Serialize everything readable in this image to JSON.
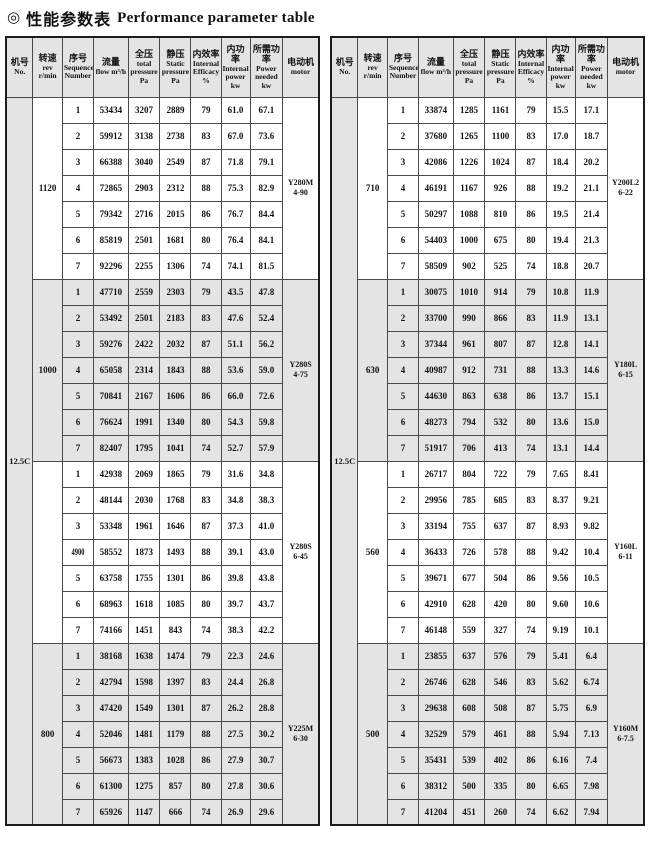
{
  "title": {
    "icon": "◎",
    "cn": "性能参数表",
    "en": "Performance parameter table"
  },
  "colors": {
    "shade": "#e4e4e4",
    "border": "#4a4a4a",
    "outer_border": "#1c1c1c",
    "text": "#111111"
  },
  "columns": [
    {
      "key": "no",
      "cn": "机号",
      "en": "No.",
      "w": "8.6%"
    },
    {
      "key": "rev",
      "cn": "转速",
      "en": "rev r/min",
      "w": "9.4%"
    },
    {
      "key": "seq",
      "cn": "序号",
      "en": "Sequence Number",
      "w": "10.0%"
    },
    {
      "key": "flow",
      "cn": "流量",
      "en": "flow m³/h",
      "w": "11.0%"
    },
    {
      "key": "total",
      "cn": "全压",
      "en": "total pressure Pa",
      "w": "10.2%"
    },
    {
      "key": "static",
      "cn": "静压",
      "en": "Static pressure Pa",
      "w": "9.9%"
    },
    {
      "key": "eff",
      "cn": "内效率",
      "en": "Internal Efficacy %",
      "w": "9.6%"
    },
    {
      "key": "ipow",
      "cn": "内功率",
      "en": "Internal power kw",
      "w": "9.3%"
    },
    {
      "key": "pneed",
      "cn": "所需功率",
      "en": "Power needed kw",
      "w": "10.4%"
    },
    {
      "key": "motor",
      "cn": "电动机",
      "en": "motor",
      "w": "11.6%"
    }
  ],
  "tables": [
    {
      "machine_no": "12.5C",
      "blocks": [
        {
          "rev": "1120",
          "motor": [
            "Y280M",
            "4-90"
          ],
          "shaded": false,
          "rows": [
            [
              "1",
              "53434",
              "3207",
              "2889",
              "79",
              "61.0",
              "67.1"
            ],
            [
              "2",
              "59912",
              "3138",
              "2738",
              "83",
              "67.0",
              "73.6"
            ],
            [
              "3",
              "66388",
              "3040",
              "2549",
              "87",
              "71.8",
              "79.1"
            ],
            [
              "4",
              "72865",
              "2903",
              "2312",
              "88",
              "75.3",
              "82.9"
            ],
            [
              "5",
              "79342",
              "2716",
              "2015",
              "86",
              "76.7",
              "84.4"
            ],
            [
              "6",
              "85819",
              "2501",
              "1681",
              "80",
              "76.4",
              "84.1"
            ],
            [
              "7",
              "92296",
              "2255",
              "1306",
              "74",
              "74.1",
              "81.5"
            ]
          ]
        },
        {
          "rev": "1000",
          "motor": [
            "Y280S",
            "4-75"
          ],
          "shaded": true,
          "rows": [
            [
              "1",
              "47710",
              "2559",
              "2303",
              "79",
              "43.5",
              "47.8"
            ],
            [
              "2",
              "53492",
              "2501",
              "2183",
              "83",
              "47.6",
              "52.4"
            ],
            [
              "3",
              "59276",
              "2422",
              "2032",
              "87",
              "51.1",
              "56.2"
            ],
            [
              "4",
              "65058",
              "2314",
              "1843",
              "88",
              "53.6",
              "59.0"
            ],
            [
              "5",
              "70841",
              "2167",
              "1606",
              "86",
              "66.0",
              "72.6"
            ],
            [
              "6",
              "76624",
              "1991",
              "1340",
              "80",
              "54.3",
              "59.8"
            ],
            [
              "7",
              "82407",
              "1795",
              "1041",
              "74",
              "52.7",
              "57.9"
            ]
          ]
        },
        {
          "rev": "",
          "motor": [
            "Y280S",
            "6-45"
          ],
          "shaded": false,
          "rows": [
            [
              "1",
              "42938",
              "2069",
              "1865",
              "79",
              "31.6",
              "34.8"
            ],
            [
              "2",
              "48144",
              "2030",
              "1768",
              "83",
              "34.8",
              "38.3"
            ],
            [
              "3",
              "53348",
              "1961",
              "1646",
              "87",
              "37.3",
              "41.0"
            ],
            [
              "4900",
              "58552",
              "1873",
              "1493",
              "88",
              "39.1",
              "43.0"
            ],
            [
              "5",
              "63758",
              "1755",
              "1301",
              "86",
              "39.8",
              "43.8"
            ],
            [
              "6",
              "68963",
              "1618",
              "1085",
              "80",
              "39.7",
              "43.7"
            ],
            [
              "7",
              "74166",
              "1451",
              "843",
              "74",
              "38.3",
              "42.2"
            ]
          ]
        },
        {
          "rev": "800",
          "motor": [
            "Y225M",
            "6-30"
          ],
          "shaded": true,
          "rows": [
            [
              "1",
              "38168",
              "1638",
              "1474",
              "79",
              "22.3",
              "24.6"
            ],
            [
              "2",
              "42794",
              "1598",
              "1397",
              "83",
              "24.4",
              "26.8"
            ],
            [
              "3",
              "47420",
              "1549",
              "1301",
              "87",
              "26.2",
              "28.8"
            ],
            [
              "4",
              "52046",
              "1481",
              "1179",
              "88",
              "27.5",
              "30.2"
            ],
            [
              "5",
              "56673",
              "1383",
              "1028",
              "86",
              "27.9",
              "30.7"
            ],
            [
              "6",
              "61300",
              "1275",
              "857",
              "80",
              "27.8",
              "30.6"
            ],
            [
              "7",
              "65926",
              "1147",
              "666",
              "74",
              "26.9",
              "29.6"
            ]
          ]
        }
      ]
    },
    {
      "machine_no": "12.5C",
      "blocks": [
        {
          "rev": "710",
          "motor": [
            "Y200L2",
            "6-22"
          ],
          "shaded": false,
          "rows": [
            [
              "1",
              "33874",
              "1285",
              "1161",
              "79",
              "15.5",
              "17.1"
            ],
            [
              "2",
              "37680",
              "1265",
              "1100",
              "83",
              "17.0",
              "18.7"
            ],
            [
              "3",
              "42086",
              "1226",
              "1024",
              "87",
              "18.4",
              "20.2"
            ],
            [
              "4",
              "46191",
              "1167",
              "926",
              "88",
              "19.2",
              "21.1"
            ],
            [
              "5",
              "50297",
              "1088",
              "810",
              "86",
              "19.5",
              "21.4"
            ],
            [
              "6",
              "54403",
              "1000",
              "675",
              "80",
              "19.4",
              "21.3"
            ],
            [
              "7",
              "58509",
              "902",
              "525",
              "74",
              "18.8",
              "20.7"
            ]
          ]
        },
        {
          "rev": "630",
          "motor": [
            "Y180L",
            "6-15"
          ],
          "shaded": true,
          "rows": [
            [
              "1",
              "30075",
              "1010",
              "914",
              "79",
              "10.8",
              "11.9"
            ],
            [
              "2",
              "33700",
              "990",
              "866",
              "83",
              "11.9",
              "13.1"
            ],
            [
              "3",
              "37344",
              "961",
              "807",
              "87",
              "12.8",
              "14.1"
            ],
            [
              "4",
              "40987",
              "912",
              "731",
              "88",
              "13.3",
              "14.6"
            ],
            [
              "5",
              "44630",
              "863",
              "638",
              "86",
              "13.7",
              "15.1"
            ],
            [
              "6",
              "48273",
              "794",
              "532",
              "80",
              "13.6",
              "15.0"
            ],
            [
              "7",
              "51917",
              "706",
              "413",
              "74",
              "13.1",
              "14.4"
            ]
          ]
        },
        {
          "rev": "560",
          "motor": [
            "Y160L",
            "6-11"
          ],
          "shaded": false,
          "rows": [
            [
              "1",
              "26717",
              "804",
              "722",
              "79",
              "7.65",
              "8.41"
            ],
            [
              "2",
              "29956",
              "785",
              "685",
              "83",
              "8.37",
              "9.21"
            ],
            [
              "3",
              "33194",
              "755",
              "637",
              "87",
              "8.93",
              "9.82"
            ],
            [
              "4",
              "36433",
              "726",
              "578",
              "88",
              "9.42",
              "10.4"
            ],
            [
              "5",
              "39671",
              "677",
              "504",
              "86",
              "9.56",
              "10.5"
            ],
            [
              "6",
              "42910",
              "628",
              "420",
              "80",
              "9.60",
              "10.6"
            ],
            [
              "7",
              "46148",
              "559",
              "327",
              "74",
              "9.19",
              "10.1"
            ]
          ]
        },
        {
          "rev": "500",
          "motor": [
            "Y160M",
            "6-7.5"
          ],
          "shaded": true,
          "rows": [
            [
              "1",
              "23855",
              "637",
              "576",
              "79",
              "5.41",
              "6.4"
            ],
            [
              "2",
              "26746",
              "628",
              "546",
              "83",
              "5.62",
              "6.74"
            ],
            [
              "3",
              "29638",
              "608",
              "508",
              "87",
              "5.75",
              "6.9"
            ],
            [
              "4",
              "32529",
              "579",
              "461",
              "88",
              "5.94",
              "7.13"
            ],
            [
              "5",
              "35431",
              "539",
              "402",
              "86",
              "6.16",
              "7.4"
            ],
            [
              "6",
              "38312",
              "500",
              "335",
              "80",
              "6.65",
              "7.98"
            ],
            [
              "7",
              "41204",
              "451",
              "260",
              "74",
              "6.62",
              "7.94"
            ]
          ]
        }
      ]
    }
  ]
}
